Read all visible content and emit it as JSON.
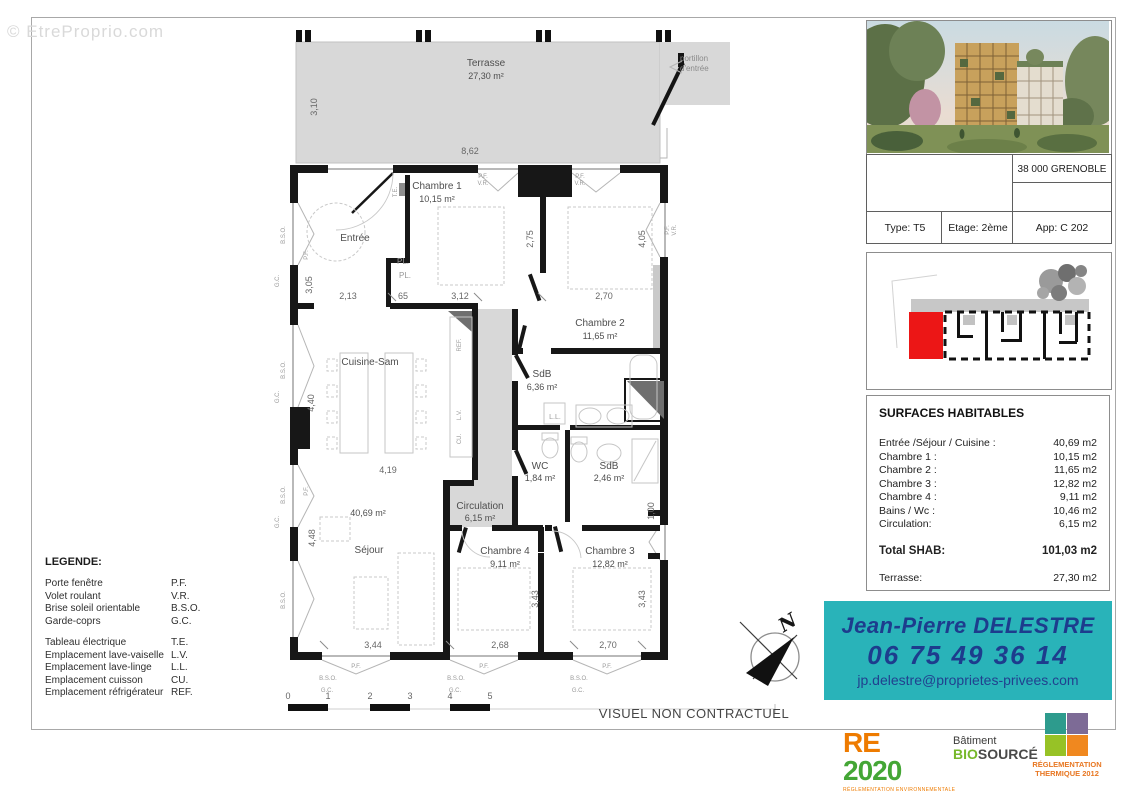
{
  "watermark": "© EtreProprio.com",
  "plan": {
    "terrace": {
      "label": "Terrasse",
      "area": "27,30 m²",
      "d_width": "8,62",
      "d_height": "3,10"
    },
    "portillon": {
      "line1": "portillon",
      "line2": "d'entrée"
    },
    "rooms": {
      "entree": {
        "name": "Entrée"
      },
      "chambre1": {
        "name": "Chambre 1",
        "area": "10,15 m²"
      },
      "chambre2": {
        "name": "Chambre 2",
        "area": "11,65 m²"
      },
      "cuisine": {
        "name": "Cuisine-Sam"
      },
      "sdb1": {
        "name": "SdB",
        "area": "6,36 m²"
      },
      "wc": {
        "name": "WC",
        "area": "1,84 m²"
      },
      "sdb2": {
        "name": "SdB",
        "area": "2,46 m²"
      },
      "circulation": {
        "name": "Circulation",
        "area": "6,15 m²"
      },
      "sejour": {
        "name": "Séjour",
        "area": "40,69 m²"
      },
      "chambre4": {
        "name": "Chambre 4",
        "area": "9,11 m²"
      },
      "chambre3": {
        "name": "Chambre 3",
        "area": "12,82 m²"
      }
    },
    "dims": {
      "d305": "3,05",
      "d213": "2,13",
      "d65": "65",
      "d312": "3,12",
      "d270a": "2,70",
      "d275": "2,75",
      "d405": "4,05",
      "d440": "4,40",
      "d419": "4,19",
      "d448": "4,48",
      "d344": "3,44",
      "d268": "2,68",
      "d270b": "2,70",
      "d343a": "3,43",
      "d343b": "3,43",
      "d100": "1,00"
    },
    "tags": {
      "pf": "P.F.",
      "vr": "V.R.",
      "bso": "B.S.O.",
      "gc": "G.C.",
      "te": "T.E.",
      "pl": "PL.",
      "ref": "REF.",
      "lv": "L.V.",
      "cu": "CU.",
      "ll": "L.L."
    },
    "compass": {
      "n": "N"
    },
    "scale": {
      "t0": "0",
      "t1": "1",
      "t2": "2",
      "t3": "3",
      "t4": "4",
      "t5": "5"
    },
    "disclaimer": "VISUEL NON CONTRACTUEL"
  },
  "legend": {
    "title": "LEGENDE:",
    "group1": [
      {
        "label": "Porte fenêtre",
        "abbr": "P.F."
      },
      {
        "label": "Volet roulant",
        "abbr": "V.R."
      },
      {
        "label": "Brise soleil orientable",
        "abbr": "B.S.O."
      },
      {
        "label": "Garde-coprs",
        "abbr": "G.C."
      }
    ],
    "group2": [
      {
        "label": "Tableau électrique",
        "abbr": "T.E."
      },
      {
        "label": "Emplacement lave-vaiselle",
        "abbr": "L.V."
      },
      {
        "label": "Emplacement lave-linge",
        "abbr": "L.L."
      },
      {
        "label": "Emplacement cuisson",
        "abbr": "CU."
      },
      {
        "label": "Emplacement réfrigérateur",
        "abbr": "REF."
      }
    ]
  },
  "panel": {
    "city": "38 000 GRENOBLE",
    "unit": {
      "type": "Type: T5",
      "etage": "Etage: 2ème",
      "app": "App: C 202"
    },
    "keyplan": {
      "highlight_color": "#ec1616"
    },
    "surfaces": {
      "title": "SURFACES HABITABLES",
      "rows": [
        {
          "label": "Entrée /Séjour / Cuisine :",
          "value": "40,69 m2"
        },
        {
          "label": "Chambre 1 :",
          "value": "10,15 m2"
        },
        {
          "label": "Chambre 2 :",
          "value": "11,65 m2"
        },
        {
          "label": "Chambre 3 :",
          "value": "12,82 m2"
        },
        {
          "label": "Chambre 4 :",
          "value": "9,11 m2"
        },
        {
          "label": "Bains / Wc :",
          "value": "10,46 m2"
        },
        {
          "label": "Circulation:",
          "value": "6,15 m2"
        }
      ],
      "total": {
        "label": "Total SHAB:",
        "value": "101,03 m2"
      },
      "terrasse": {
        "label": "Terrasse:",
        "value": "27,30 m2"
      }
    }
  },
  "contact": {
    "name": "Jean-Pierre DELESTRE",
    "phone": "06 75 49 36 14",
    "email": "jp.delestre@proprietes-privees.com",
    "bg_color": "#29b3b9",
    "text_color": "#1d3c8d"
  },
  "logos": {
    "re2020": {
      "re": "RE",
      "year": "2020",
      "caption": "RÉGLEMENTATION ENVIRONNEMENTALE",
      "re_color": "#ee7b00",
      "year_color": "#44a635"
    },
    "biosource": {
      "word": "Bâtiment",
      "bio": "BIO",
      "source": "SOURCÉ",
      "bio_color": "#76b82a"
    },
    "rt2012": {
      "caption1": "RÉGLEMENTATION",
      "caption2": "THERMIQUE 2012",
      "colors": [
        "#2d9b8d",
        "#7d6b96",
        "#97c226",
        "#f0881f"
      ]
    }
  }
}
